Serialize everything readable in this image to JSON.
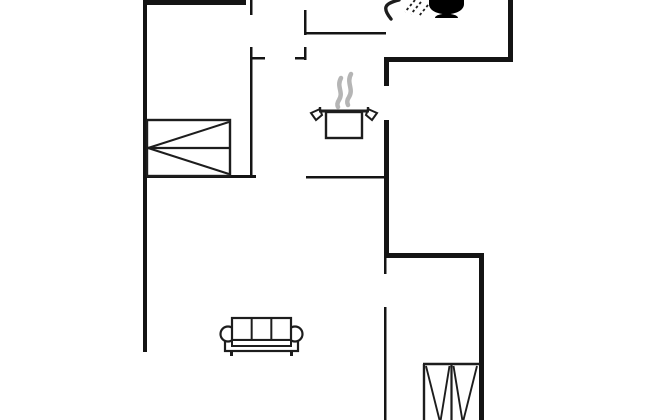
{
  "canvas": {
    "width": 650,
    "height": 420,
    "background": "#ffffff"
  },
  "palette": {
    "wall": "#141414",
    "line": "#1d1d1d",
    "fill": "#ffffff",
    "fixture_fill": "#000000",
    "steam": "#b5b5b5"
  },
  "floor_plan": {
    "walls_thick": [
      {
        "name": "bedroom1-top-wall",
        "x": 143,
        "y": 0,
        "w": 103,
        "h": 5
      },
      {
        "name": "left-exterior-wall",
        "x": 143,
        "y": 0,
        "w": 4,
        "h": 352
      },
      {
        "name": "bathroom-right-wall",
        "x": 508,
        "y": 0,
        "w": 5,
        "h": 62
      },
      {
        "name": "bathroom-bottom-wall",
        "x": 386,
        "y": 57,
        "w": 127,
        "h": 5
      },
      {
        "name": "kitchen-wall-upper",
        "x": 384,
        "y": 57,
        "w": 5,
        "h": 29
      },
      {
        "name": "kitchen-wall-lower",
        "x": 384,
        "y": 120,
        "w": 5,
        "h": 138
      },
      {
        "name": "bedroom2-top-wall",
        "x": 384,
        "y": 253,
        "w": 100,
        "h": 5
      },
      {
        "name": "bedroom2-right-wall",
        "x": 479,
        "y": 253,
        "w": 5,
        "h": 167
      }
    ],
    "walls_thin": [
      {
        "name": "bedroom1-door-jamb",
        "x": 250,
        "y": 0,
        "w": 2.5,
        "h": 15
      },
      {
        "name": "bedroom1-right-wall",
        "x": 250,
        "y": 47,
        "w": 2.5,
        "h": 131
      },
      {
        "name": "hall-stub-left",
        "x": 250,
        "y": 57,
        "w": 15,
        "h": 2.5
      },
      {
        "name": "hall-stub-right",
        "x": 295,
        "y": 57,
        "w": 11,
        "h": 2.5
      },
      {
        "name": "hall-jamb-lower",
        "x": 304,
        "y": 47,
        "w": 2.5,
        "h": 13
      },
      {
        "name": "hall-jamb-upper",
        "x": 304,
        "y": 10,
        "w": 2.5,
        "h": 25
      },
      {
        "name": "corridor-top-wall",
        "x": 304,
        "y": 32,
        "w": 82,
        "h": 2.5
      },
      {
        "name": "bedroom1-bottom-wall",
        "x": 143,
        "y": 175,
        "w": 113,
        "h": 3
      },
      {
        "name": "kitchen-counter-wall",
        "x": 306,
        "y": 176,
        "w": 80,
        "h": 2.5
      },
      {
        "name": "bedroom2-door-jamb",
        "x": 384,
        "y": 258,
        "w": 2.5,
        "h": 16
      },
      {
        "name": "bedroom2-left-wall",
        "x": 384,
        "y": 307,
        "w": 2.5,
        "h": 113
      }
    ],
    "furniture": {
      "bed_top_left": {
        "icon": "double-bed-icon",
        "x": 147,
        "y": 120,
        "w": 83,
        "h": 56
      },
      "bed_bottom_right": {
        "icon": "double-bed-2-icon",
        "x": 423,
        "y": 364,
        "w": 57,
        "h": 56
      },
      "sofa": {
        "icon": "sofa-icon",
        "x": 220,
        "y": 318,
        "w": 83,
        "h": 38
      }
    },
    "kitchen": {
      "pot": {
        "icon": "cooking-pot-icon",
        "rim_x1": 319,
        "rim_x2": 369,
        "rim_y": 111,
        "body_x": 326,
        "body_y": 112,
        "body_w": 36,
        "body_h": 26
      },
      "steam": {
        "icon": "steam-icon",
        "x": 336,
        "y": 74,
        "w": 18,
        "h": 34
      }
    },
    "bathroom": {
      "shower": {
        "icon": "shower-head-icon",
        "x": 386,
        "y": 0,
        "w": 14,
        "h": 19
      },
      "spray": {
        "icon": "shower-spray-icon",
        "x": 405,
        "y": 0,
        "w": 23,
        "h": 16
      },
      "toilet": {
        "icon": "toilet-icon",
        "x": 429,
        "y": 0,
        "w": 35,
        "h": 18
      }
    }
  }
}
